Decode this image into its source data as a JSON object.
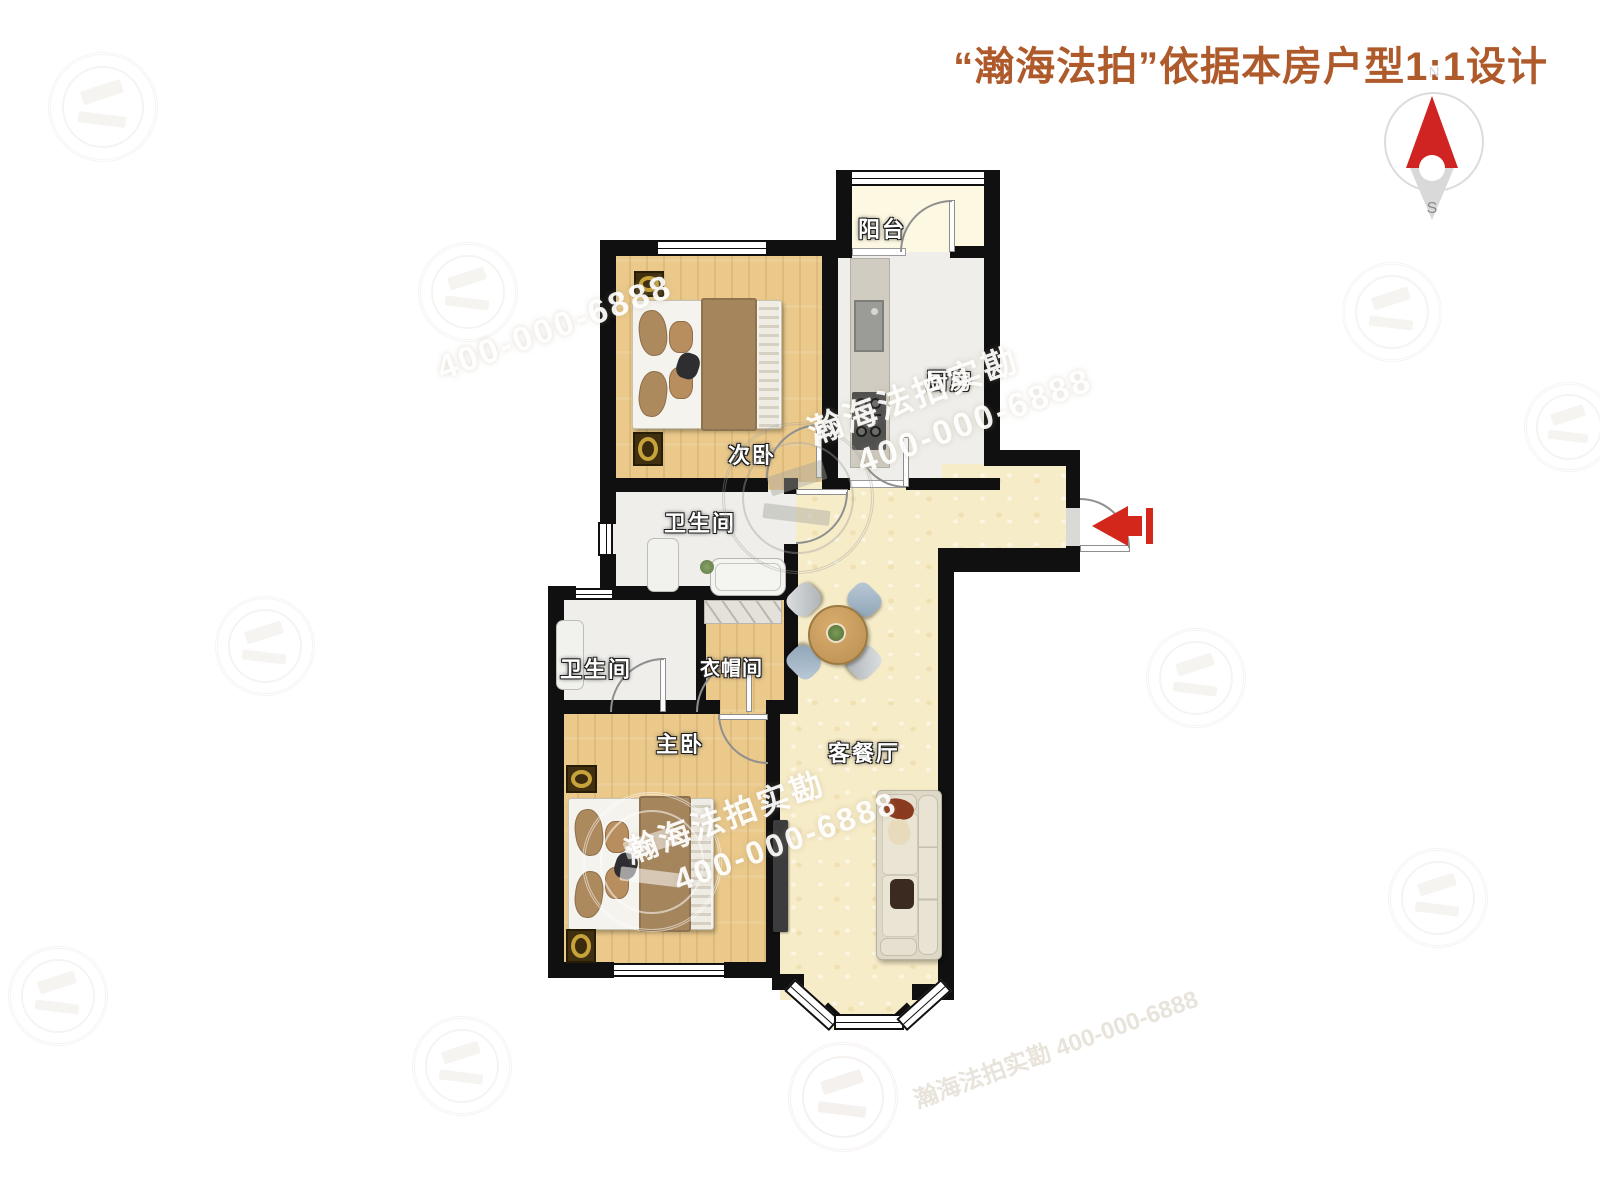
{
  "header": {
    "title": "“瀚海法拍”依据本房户型1:1设计"
  },
  "compass": {
    "north_label": "N",
    "south_label": "S"
  },
  "rooms": {
    "balcony": "阳台",
    "kitchen": "厨房",
    "bedroom2": "次卧",
    "bath1": "卫生间",
    "bath2": "卫生间",
    "cloakroom": "衣帽间",
    "master": "主卧",
    "living": "客餐厅"
  },
  "watermark": {
    "brand": "瀚海法拍实勘",
    "phone": "400-000-6888"
  },
  "furniture_icons": [
    "double-bed",
    "nightstand-lamp",
    "kitchen-counter",
    "sink",
    "gas-stove",
    "bathtub",
    "shower-cabinet",
    "wardrobe",
    "round-dining-table",
    "chair",
    "sofa",
    "tv-panel",
    "entry-arrow",
    "compass-needle"
  ],
  "colors": {
    "title_text": "#AE5A2B",
    "wall": "#101010",
    "wood_floor": "#EAC98B",
    "living_floor": "#F7ECC8",
    "balcony_floor": "#FCF8E2",
    "tile_floor": "#EFEEEA",
    "entry_arrow": "#D3271B",
    "compass_red": "#CF2421"
  }
}
